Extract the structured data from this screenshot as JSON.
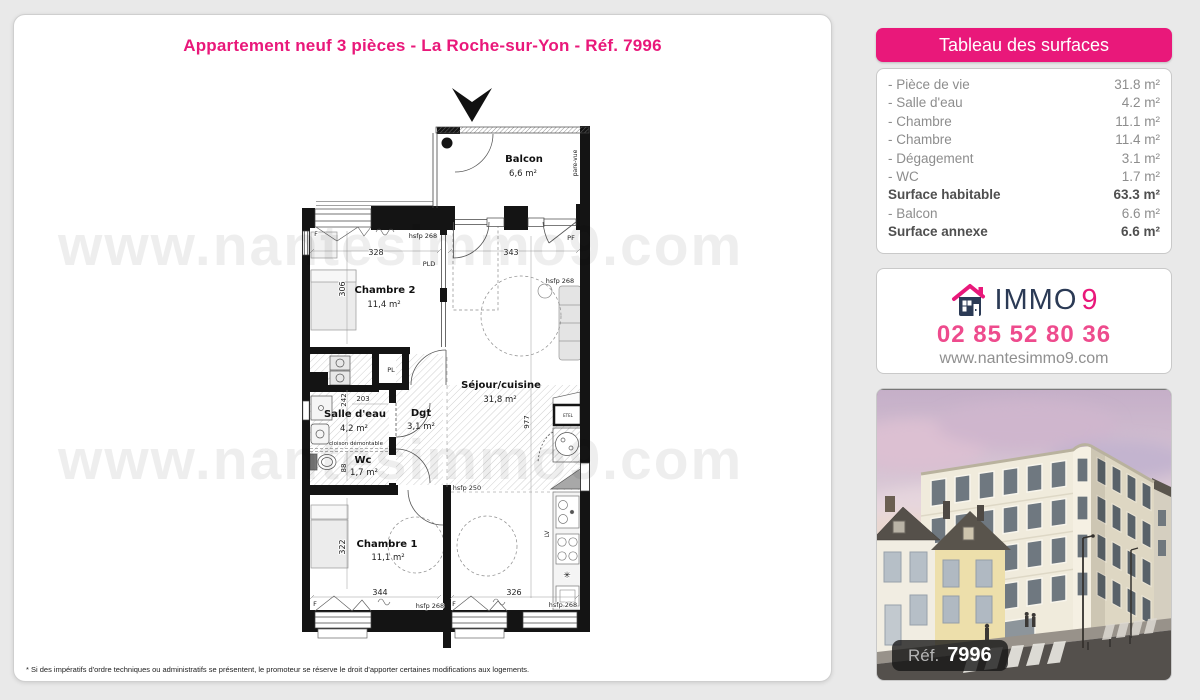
{
  "page": {
    "title": "Appartement neuf 3 pièces - La Roche-sur-Yon - Réf. 7996",
    "footnote": "* Si des impératifs d'ordre techniques ou administratifs se présentent, le promoteur se réserve le droit d'apporter certaines modifications aux logements."
  },
  "colors": {
    "accent_pink": "#e9187a",
    "navy": "#2b3a55"
  },
  "surfaces": {
    "header": "Tableau des surfaces",
    "rows": [
      {
        "label": "- Pièce de vie",
        "value": "31.8 m²",
        "bold": false
      },
      {
        "label": "- Salle d'eau",
        "value": "4.2 m²",
        "bold": false
      },
      {
        "label": "- Chambre",
        "value": "11.1 m²",
        "bold": false
      },
      {
        "label": "- Chambre",
        "value": "11.4 m²",
        "bold": false
      },
      {
        "label": "- Dégagement",
        "value": "3.1 m²",
        "bold": false
      },
      {
        "label": "- WC",
        "value": "1.7 m²",
        "bold": false
      },
      {
        "label": "Surface habitable",
        "value": "63.3 m²",
        "bold": true
      },
      {
        "label": "- Balcon",
        "value": "6.6 m²",
        "bold": false
      },
      {
        "label": "Surface annexe",
        "value": "6.6 m²",
        "bold": true
      }
    ]
  },
  "agency": {
    "brand": "IMMO",
    "brand_suffix": "9",
    "phone": "02 85 52 80 36",
    "website": "www.nantesimmo9.com"
  },
  "photo": {
    "ref_label": "Réf.",
    "ref_number": "7996"
  },
  "plan": {
    "watermark": "www.nantesimmo9.com",
    "rooms": [
      {
        "name": "Balcon",
        "area": "6,6 m²",
        "x": 524,
        "y": 162,
        "ax": 523,
        "ay": 176
      },
      {
        "name": "Chambre 2",
        "area": "11,4 m²",
        "x": 385,
        "y": 293,
        "ax": 384,
        "ay": 307
      },
      {
        "name": "Séjour/cuisine",
        "area": "31,8 m²",
        "x": 501,
        "y": 388,
        "ax": 500,
        "ay": 402
      },
      {
        "name": "Salle d'eau",
        "area": "4,2 m²",
        "x": 355,
        "y": 417,
        "ax": 354,
        "ay": 431
      },
      {
        "name": "Dgt",
        "area": "3,1 m²",
        "x": 421,
        "y": 416,
        "ax": 421,
        "ay": 429
      },
      {
        "name": "Wc",
        "area": "1,7 m²",
        "x": 363,
        "y": 463,
        "ax": 364,
        "ay": 475
      },
      {
        "name": "Chambre 1",
        "area": "11,1 m²",
        "x": 387,
        "y": 547,
        "ax": 388,
        "ay": 560
      }
    ],
    "labels": [
      {
        "t": "pare-vue",
        "x": 577,
        "y": 163,
        "r": -90,
        "s": 6
      },
      {
        "t": "F",
        "x": 316,
        "y": 236
      },
      {
        "t": "hsfp 268",
        "x": 423,
        "y": 238
      },
      {
        "t": "PF",
        "x": 571,
        "y": 240
      },
      {
        "t": "328",
        "x": 376,
        "y": 255,
        "s": 8
      },
      {
        "t": "343",
        "x": 511,
        "y": 255,
        "s": 8
      },
      {
        "t": "PLD",
        "x": 429,
        "y": 266
      },
      {
        "t": "hsfp 268",
        "x": 560,
        "y": 283
      },
      {
        "t": "306",
        "x": 345,
        "y": 289,
        "r": -90,
        "s": 8
      },
      {
        "t": "PL",
        "x": 391,
        "y": 372
      },
      {
        "t": "242",
        "x": 346,
        "y": 400,
        "r": -90,
        "s": 7
      },
      {
        "t": "203",
        "x": 363,
        "y": 401,
        "s": 7
      },
      {
        "t": "cloison démontable",
        "x": 356,
        "y": 445,
        "s": 5.5
      },
      {
        "t": "977",
        "x": 529,
        "y": 422,
        "r": -90,
        "s": 7
      },
      {
        "t": "88",
        "x": 346,
        "y": 468,
        "r": -90,
        "s": 7
      },
      {
        "t": "ETEL",
        "x": 568,
        "y": 417,
        "s": 4
      },
      {
        "t": "hsfp 250",
        "x": 467,
        "y": 490
      },
      {
        "t": "322",
        "x": 345,
        "y": 547,
        "r": -90,
        "s": 8
      },
      {
        "t": "LV",
        "x": 549,
        "y": 534,
        "r": -90,
        "s": 6
      },
      {
        "t": "✳",
        "x": 567,
        "y": 578,
        "s": 9
      },
      {
        "t": "344",
        "x": 380,
        "y": 595,
        "s": 8
      },
      {
        "t": "326",
        "x": 514,
        "y": 595,
        "s": 8
      },
      {
        "t": "F",
        "x": 315,
        "y": 606
      },
      {
        "t": "hsfp 268",
        "x": 430,
        "y": 608
      },
      {
        "t": "F",
        "x": 454,
        "y": 606
      },
      {
        "t": "hsfp 268",
        "x": 563,
        "y": 607
      }
    ]
  }
}
